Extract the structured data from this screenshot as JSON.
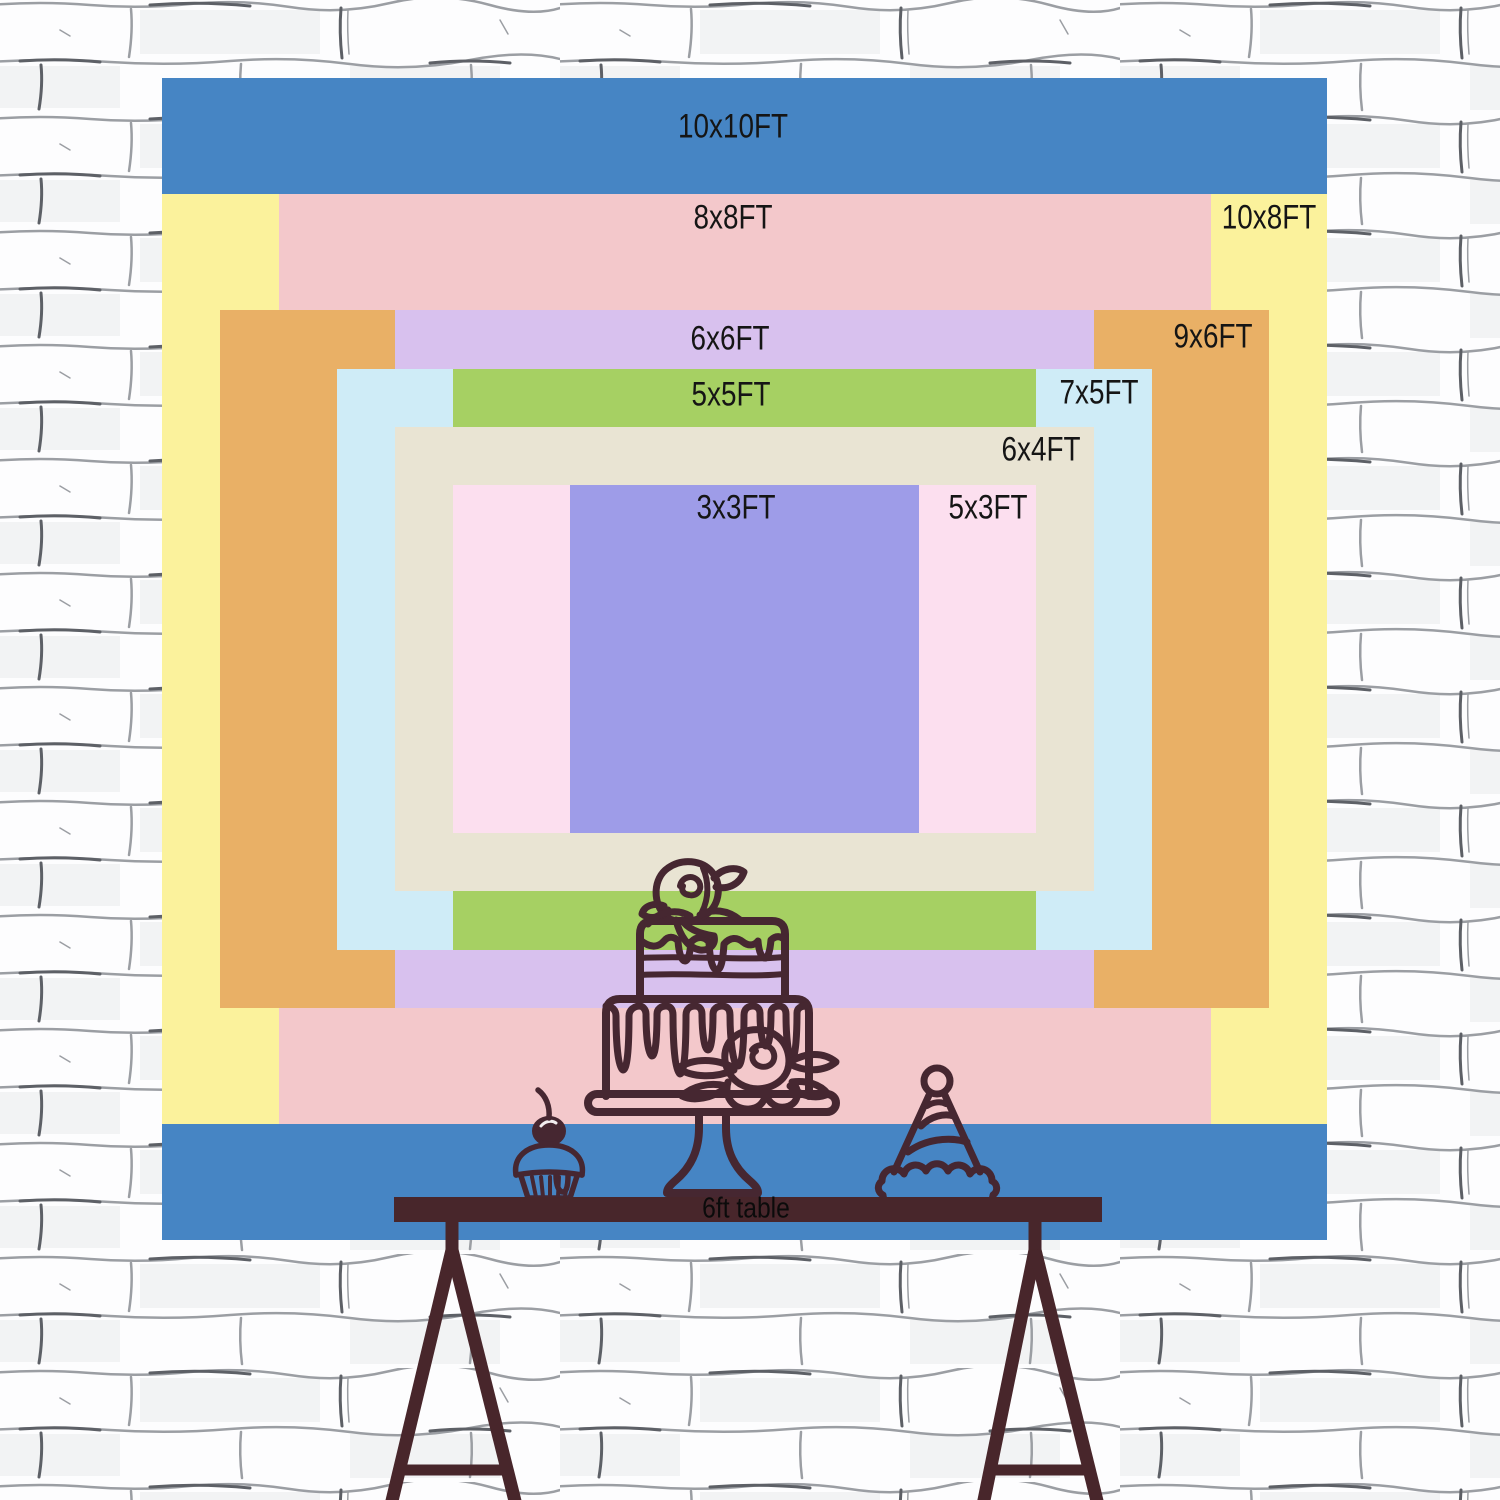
{
  "wall": {
    "base_color": "#fdfdfe",
    "mortar_light": "#9b9ea3",
    "mortar_dark": "#5d6066",
    "patch_color": "#f2f3f4"
  },
  "backdrop": {
    "label_text_color": "#151515",
    "layers": [
      {
        "id": "10x10",
        "label": "10x10FT",
        "width_ft": 10,
        "height_ft": 10,
        "color": "#4685c4"
      },
      {
        "id": "10x8",
        "label": "10x8FT",
        "width_ft": 10,
        "height_ft": 8,
        "color": "#fbf29c"
      },
      {
        "id": "8x8",
        "label": "8x8FT",
        "width_ft": 8,
        "height_ft": 8,
        "color": "#f3c8cb"
      },
      {
        "id": "9x6",
        "label": "9x6FT",
        "width_ft": 9,
        "height_ft": 6,
        "color": "#e9b066"
      },
      {
        "id": "6x6",
        "label": "6x6FT",
        "width_ft": 6,
        "height_ft": 6,
        "color": "#d8c1ee"
      },
      {
        "id": "7x5",
        "label": "7x5FT",
        "width_ft": 7,
        "height_ft": 5,
        "color": "#cfecf7"
      },
      {
        "id": "5x5",
        "label": "5x5FT",
        "width_ft": 5,
        "height_ft": 5,
        "color": "#a6d063"
      },
      {
        "id": "6x4",
        "label": "6x4FT",
        "width_ft": 6,
        "height_ft": 4,
        "color": "#e9e4d3"
      },
      {
        "id": "5x3",
        "label": "5x3FT",
        "width_ft": 5,
        "height_ft": 3,
        "color": "#fcdfef"
      },
      {
        "id": "3x3",
        "label": "3x3FT",
        "width_ft": 3,
        "height_ft": 3,
        "color": "#9e9ce8"
      }
    ]
  },
  "table": {
    "label": "6ft table",
    "wood_color": "#48262b"
  },
  "decor": {
    "outline_color": "#462731",
    "highlight_color": "#f3eef0",
    "items": [
      "cupcake",
      "tiered-birthday-cake",
      "party-hat"
    ]
  }
}
